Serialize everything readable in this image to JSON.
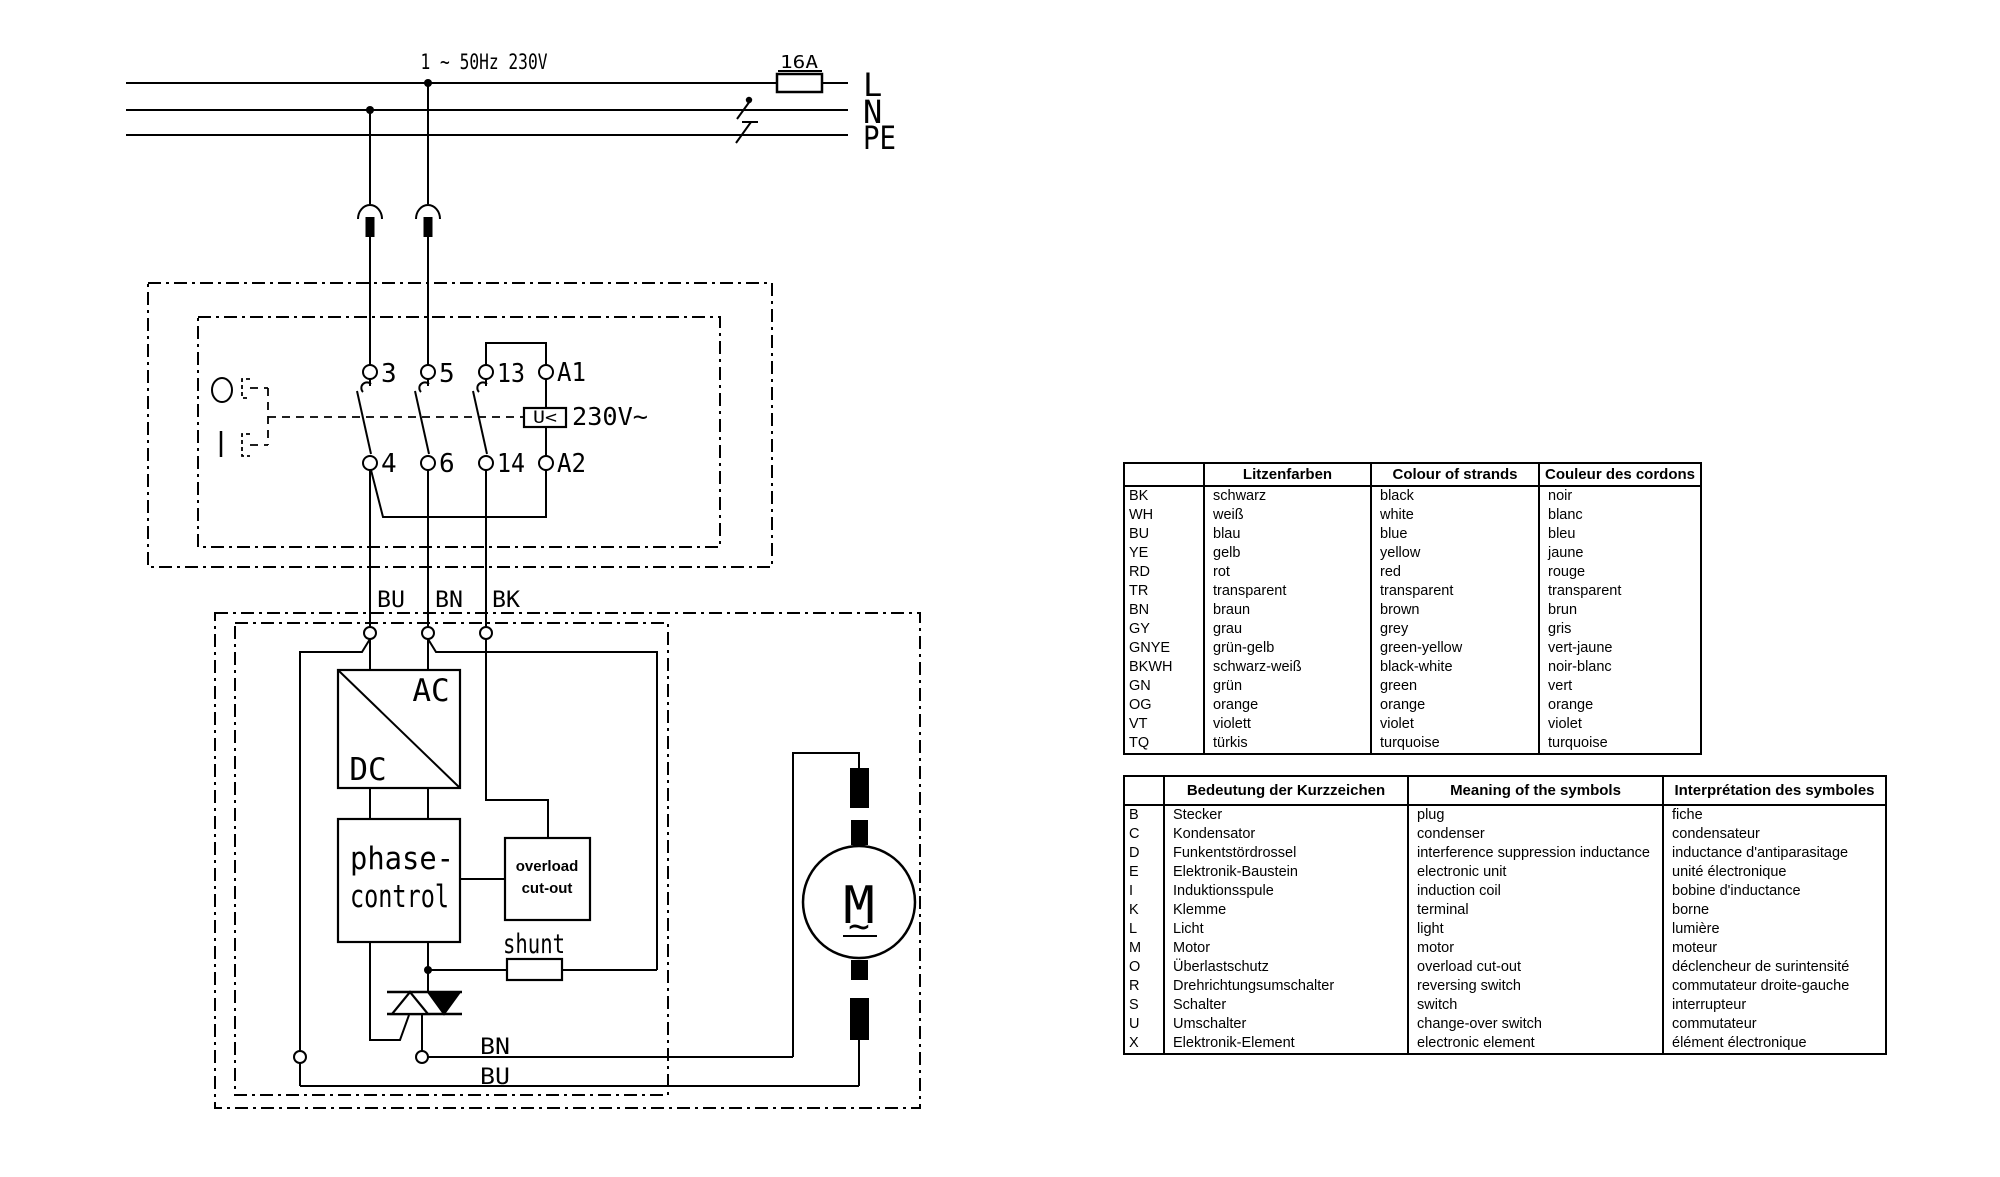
{
  "diagram": {
    "supply_label": "1 ~ 50Hz  230V",
    "fuse_rating": "16A",
    "line_l": "L",
    "line_n": "N",
    "line_pe": "PE",
    "contactor": {
      "t3": "3",
      "t5": "5",
      "t13": "13",
      "ta1": "A1",
      "t4": "4",
      "t6": "6",
      "t14": "14",
      "ta2": "A2",
      "coil": "U<",
      "coil_voltage": "230V~"
    },
    "wire_bu": "BU",
    "wire_bn": "BN",
    "wire_bk": "BK",
    "acdc_top": "AC",
    "acdc_bottom": "DC",
    "phase_line1": "phase-",
    "phase_line2": "control",
    "overload_line1": "overload",
    "overload_line2": "cut-out",
    "shunt_label": "shunt",
    "out_bn": "BN",
    "out_bu": "BU",
    "motor_label": "M",
    "motor_wave": "~"
  },
  "color_table": {
    "headers": [
      "",
      "Litzenfarben",
      "Colour of strands",
      "Couleur des cordons"
    ],
    "rows": [
      [
        "BK",
        "schwarz",
        "black",
        "noir"
      ],
      [
        "WH",
        "weiß",
        "white",
        "blanc"
      ],
      [
        "BU",
        "blau",
        "blue",
        "bleu"
      ],
      [
        "YE",
        "gelb",
        "yellow",
        "jaune"
      ],
      [
        "RD",
        "rot",
        "red",
        "rouge"
      ],
      [
        "TR",
        "transparent",
        "transparent",
        "transparent"
      ],
      [
        "BN",
        "braun",
        "brown",
        "brun"
      ],
      [
        "GY",
        "grau",
        "grey",
        "gris"
      ],
      [
        "GNYE",
        "grün-gelb",
        "green-yellow",
        "vert-jaune"
      ],
      [
        "BKWH",
        "schwarz-weiß",
        "black-white",
        "noir-blanc"
      ],
      [
        "GN",
        "grün",
        "green",
        "vert"
      ],
      [
        "OG",
        "orange",
        "orange",
        "orange"
      ],
      [
        "VT",
        "violett",
        "violet",
        "violet"
      ],
      [
        "TQ",
        "türkis",
        "turquoise",
        "turquoise"
      ]
    ]
  },
  "symbol_table": {
    "headers": [
      "",
      "Bedeutung der Kurzzeichen",
      "Meaning of the symbols",
      "Interprétation des symboles"
    ],
    "rows": [
      [
        "B",
        "Stecker",
        "plug",
        "fiche"
      ],
      [
        "C",
        "Kondensator",
        "condenser",
        "condensateur"
      ],
      [
        "D",
        "Funkentstördrossel",
        "interference suppression inductance",
        "inductance d'antiparasitage"
      ],
      [
        "E",
        "Elektronik-Baustein",
        "electronic unit",
        "unité électronique"
      ],
      [
        "I",
        "Induktionsspule",
        "induction coil",
        "bobine d'inductance"
      ],
      [
        "K",
        "Klemme",
        "terminal",
        "borne"
      ],
      [
        "L",
        "Licht",
        "light",
        "lumière"
      ],
      [
        "M",
        "Motor",
        "motor",
        "moteur"
      ],
      [
        "O",
        "Überlastschutz",
        "overload cut-out",
        "déclencheur de surintensité"
      ],
      [
        "R",
        "Drehrichtungsumschalter",
        "reversing switch",
        "commutateur droite-gauche"
      ],
      [
        "S",
        "Schalter",
        "switch",
        "interrupteur"
      ],
      [
        "U",
        "Umschalter",
        "change-over switch",
        "commutateur"
      ],
      [
        "X",
        "Elektronik-Element",
        "electronic element",
        "élément électronique"
      ]
    ]
  }
}
